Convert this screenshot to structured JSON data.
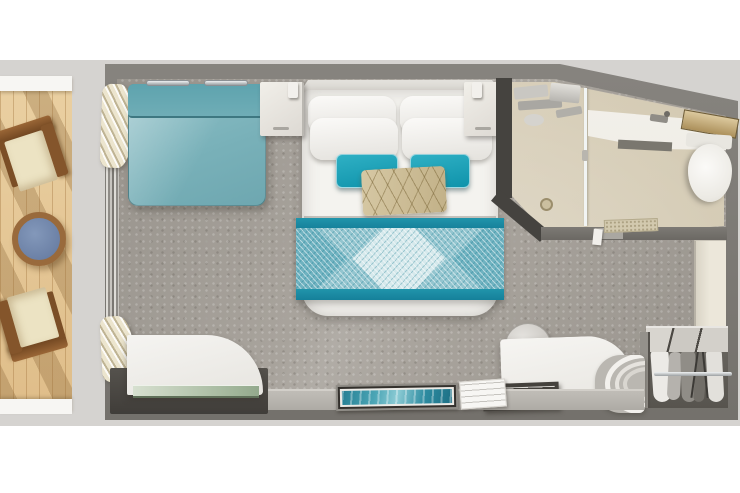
{
  "page": {
    "title": "Balcony Stateroom Floor Plan",
    "background_color": "#ffffff"
  },
  "plan": {
    "regions": {
      "balcony": {
        "label": "Balcony",
        "deck_color": "#e4c491",
        "furniture": [
          "deck chair",
          "round side table",
          "deck chair"
        ]
      },
      "stateroom": {
        "label": "Stateroom",
        "carpet_color": "#a8a39c",
        "furniture": [
          "teal sofa",
          "double bed with teal runner",
          "nightstand",
          "nightstand",
          "curtains",
          "sliding balcony door",
          "curved desk with glass shelf",
          "framed teal artwork",
          "desk with round stool",
          "storage tray",
          "curved screen",
          "wardrobe with hanging clothes",
          "side cabinet"
        ]
      },
      "bathroom": {
        "label": "Bathroom",
        "floor_color": "#d9d0bb",
        "fixtures": [
          "shower with glass partition",
          "shower controls",
          "floor drain",
          "vanity counter with faucet",
          "mirror shelf",
          "toilet",
          "bath mat"
        ]
      }
    },
    "labels": {
      "balcony": "Balcony",
      "deck_chair": "Deck chair",
      "deck_table": "Round side table",
      "curtains": "Curtains",
      "balcony_door": "Sliding balcony door",
      "sofa": "Teal sofa",
      "bed": "Double bed",
      "bed_runner": "Teal bed runner",
      "accent_pillow": "Geometric accent pillow",
      "nightstand": "Nightstand",
      "headboard": "Headboard",
      "bathroom": "Bathroom",
      "shower": "Shower",
      "shower_glass": "Shower glass partition",
      "drain": "Floor drain",
      "vanity": "Vanity counter",
      "mirror": "Mirror shelf",
      "toilet": "Toilet",
      "bath_mat": "Bath mat",
      "cabinet": "Side cabinet",
      "wardrobe": "Wardrobe with hanging clothes",
      "stool": "Round stool",
      "desk_right": "Vanity desk",
      "tray": "Storage tray",
      "screen": "Curved screen",
      "desk_left": "Curved desk",
      "glass_shelf": "Glass shelf",
      "artwork": "Framed artwork",
      "pad": "Notepad",
      "carpet": "Carpet",
      "walls": "Cabin walls"
    },
    "colors": {
      "wall": "#7a7772",
      "surround": "#d5d3d0",
      "carpet": "#a8a39c",
      "deck_wood": "#e4c491",
      "sofa_teal": "#7fb6be",
      "pillow_teal": "#16a0b7",
      "accent_pillow_tan": "#ccbd98",
      "runner_teal_dark": "#1d93a9",
      "runner_teal_light": "#93c5cf",
      "bathroom_floor": "#d9d0bb",
      "artwork_teal": "#2d93a5",
      "table_top_blue": "#6c81a6"
    }
  }
}
